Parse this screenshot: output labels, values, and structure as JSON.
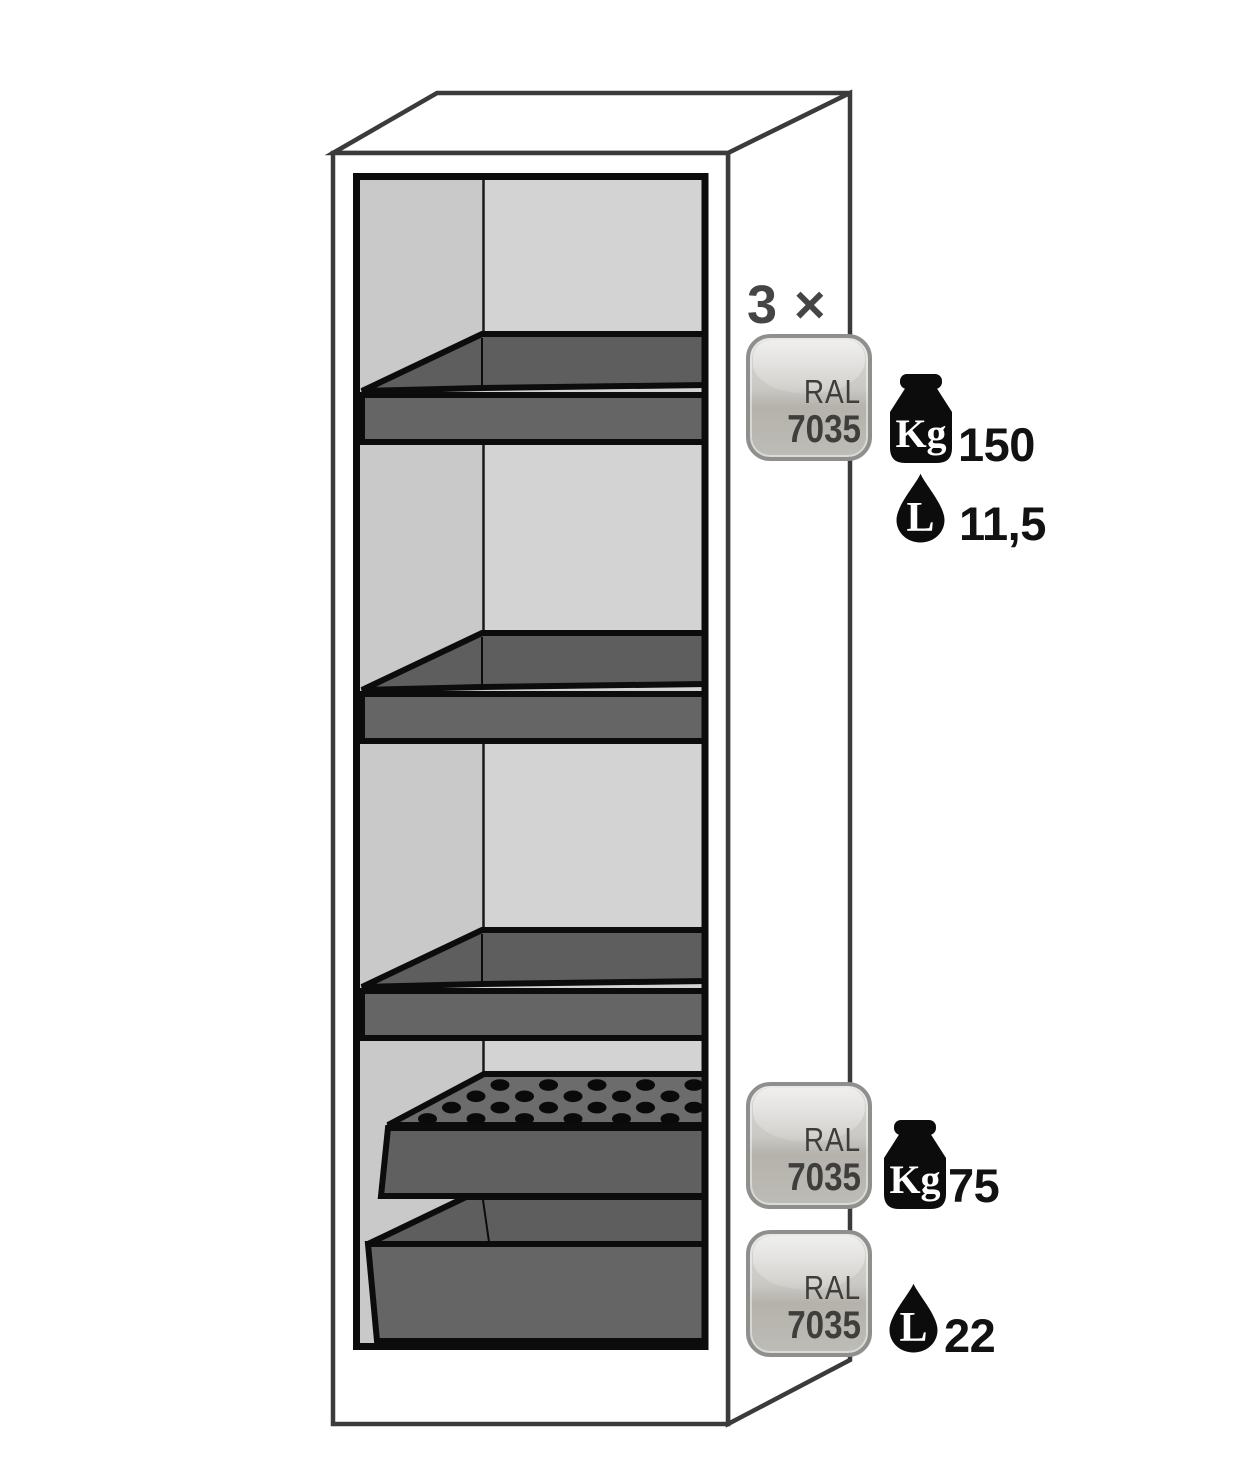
{
  "shelf_group": {
    "quantity_label": "3 ×",
    "badge": {
      "standard": "RAL",
      "code": "7035"
    },
    "load": {
      "unit": "Kg",
      "value": "150"
    },
    "volume": {
      "unit": "L",
      "value": "11,5"
    }
  },
  "insert_group": {
    "badge": {
      "standard": "RAL",
      "code": "7035"
    },
    "load": {
      "unit": "Kg",
      "value": "75"
    }
  },
  "sump_group": {
    "badge": {
      "standard": "RAL",
      "code": "7035"
    },
    "volume": {
      "unit": "L",
      "value": "22"
    }
  },
  "colors": {
    "outline": "#3b3b3b",
    "ink": "#0c0c0c",
    "wall_left": "#c9c9c9",
    "wall_back": "#d3d3d3",
    "tray_top": "#5e5e5e",
    "tray_front": "#656565",
    "perforated_top": "#6c6c6c",
    "badge_border": "#8f8f8d",
    "badge_fill_light": "#d8d7d4",
    "badge_fill_dark": "#b5b2ac",
    "badge_text": "#3e3e3c",
    "label_text": "#454545",
    "value_text": "#121212"
  }
}
